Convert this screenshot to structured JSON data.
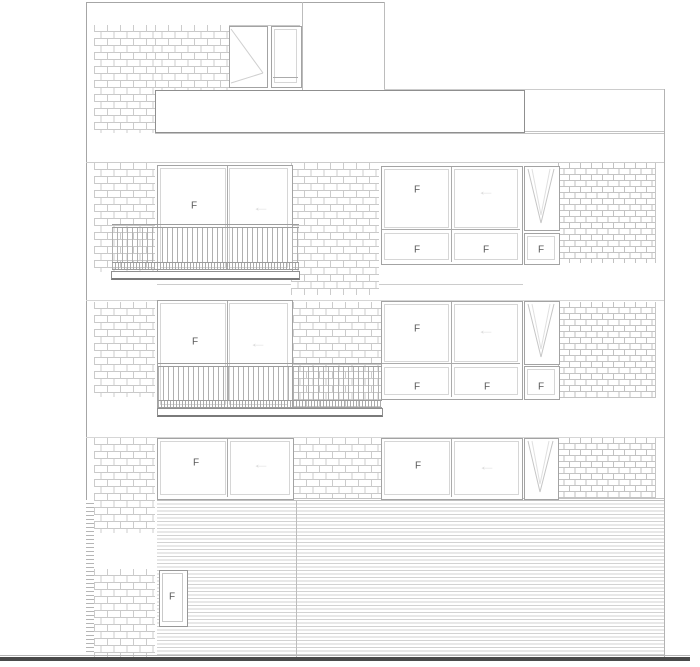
{
  "drawing": {
    "kind": "architectural front elevation, three storeys with staggered balconies",
    "colors": {
      "background": "#ffffff",
      "line": "#b3b3b3",
      "frame": "#a3a3a3",
      "brick_line": "#c9c9c9",
      "ground": "#4a4a4a",
      "label": "#585858",
      "arrow": "#dcdcdc"
    },
    "f_labels": [
      {
        "text": "F",
        "loc": "third-floor-balcony-door"
      },
      {
        "text": "F",
        "loc": "third-floor-window-upper-left"
      },
      {
        "text": "F",
        "loc": "third-floor-window-lower-left"
      },
      {
        "text": "F",
        "loc": "third-floor-window-lower-right"
      },
      {
        "text": "F",
        "loc": "third-floor-side-window-lower"
      },
      {
        "text": "F",
        "loc": "second-floor-balcony-door"
      },
      {
        "text": "F",
        "loc": "second-floor-window-upper-left"
      },
      {
        "text": "F",
        "loc": "second-floor-window-lower-left"
      },
      {
        "text": "F",
        "loc": "second-floor-window-lower-right"
      },
      {
        "text": "F",
        "loc": "second-floor-side-window-lower"
      },
      {
        "text": "F",
        "loc": "ground-floor-window-left"
      },
      {
        "text": "F",
        "loc": "ground-floor-window-right"
      },
      {
        "text": "F",
        "loc": "entry-door"
      }
    ],
    "arrows": [
      {
        "glyph": "←",
        "loc": "third-floor-balcony-door-slider"
      },
      {
        "glyph": "←",
        "loc": "third-floor-window-slider"
      },
      {
        "glyph": "←",
        "loc": "second-floor-balcony-door-slider"
      },
      {
        "glyph": "←",
        "loc": "second-floor-window-slider"
      },
      {
        "glyph": "←",
        "loc": "ground-floor-left-window-slider"
      },
      {
        "glyph": "←",
        "loc": "ground-floor-right-window-slider"
      }
    ]
  }
}
